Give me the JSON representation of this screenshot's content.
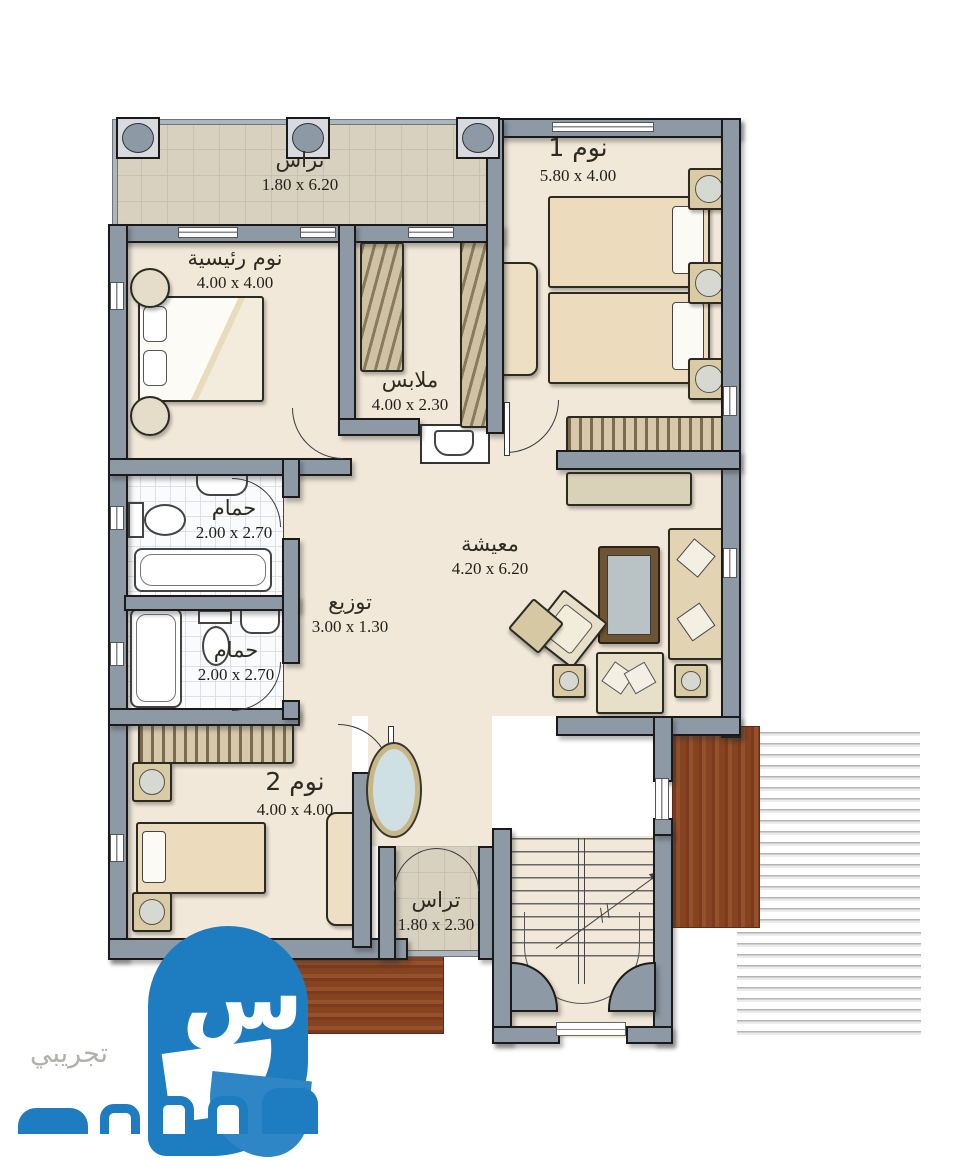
{
  "plan": {
    "title": "villa-first-floor-plan",
    "rooms": [
      {
        "id": "terrace-top",
        "label": "تراس",
        "dims": "1.80 x 6.20"
      },
      {
        "id": "bedroom-1",
        "label": "نوم 1",
        "dims": "5.80 x 4.00"
      },
      {
        "id": "master-bedroom",
        "label": "نوم رئيسية",
        "dims": "4.00 x 4.00"
      },
      {
        "id": "dressing-room",
        "label": "ملابس",
        "dims": "4.00 x 2.30"
      },
      {
        "id": "bathroom-1",
        "label": "حمام",
        "dims": "2.00 x 2.70"
      },
      {
        "id": "bathroom-2",
        "label": "حمام",
        "dims": "2.00 x 2.70"
      },
      {
        "id": "hallway",
        "label": "توزيع",
        "dims": "3.00 x 1.30"
      },
      {
        "id": "living-room",
        "label": "معيشة",
        "dims": "4.20 x 6.20"
      },
      {
        "id": "bedroom-2",
        "label": "نوم 2",
        "dims": "4.00 x 4.00"
      },
      {
        "id": "terrace-bottom",
        "label": "تراس",
        "dims": "1.80 x 2.30"
      }
    ]
  },
  "watermark": {
    "status_label": "تجريبي",
    "logo_glyph": "س"
  },
  "colors": {
    "wall": "#8e99a6",
    "floor": "#f2e8d9",
    "terrace_tile": "#d8d1c0",
    "wood_deck": "#8a4527",
    "furniture": "#ecdfc4",
    "logo_blue": "#1e7cc1",
    "watermark_gray": "#b2b0ab"
  }
}
